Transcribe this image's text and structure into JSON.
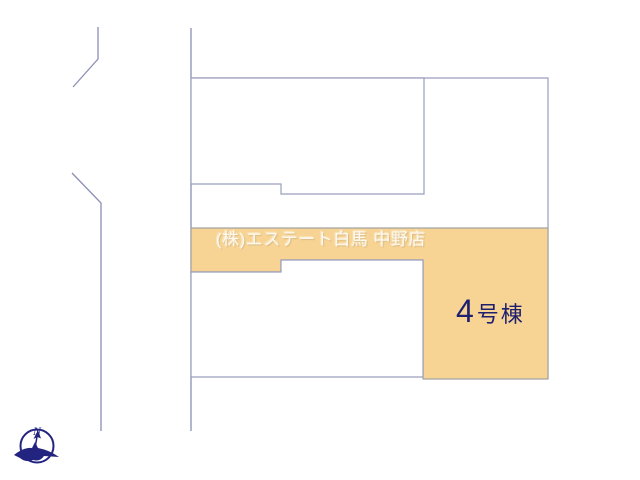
{
  "site_plan": {
    "watermark": "(株)エステート白馬 中野店",
    "highlighted_lot": {
      "label": "4号棟",
      "number": "4",
      "suffix": "号棟"
    },
    "compass": {
      "north_label": "N"
    },
    "colors": {
      "background": "#FFFFFF",
      "lot_highlight_fill": "#F7D494",
      "parcel_border_line": "#9A9DBE",
      "road_line": "#8B8FB6",
      "lot_label_text": "#1F1F70",
      "watermark_text": "rgba(255,253,247,0.88)",
      "compass_navy": "#232380"
    }
  }
}
